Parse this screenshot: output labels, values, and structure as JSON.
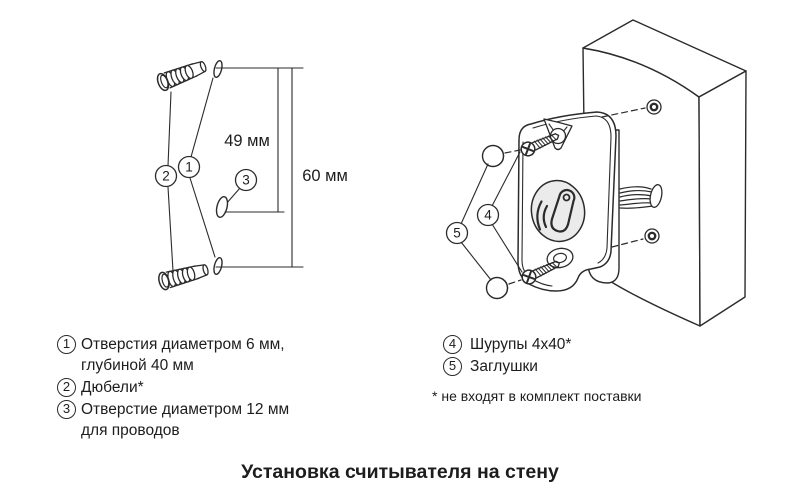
{
  "title": "Установка считывателя на стену",
  "diagram_left": {
    "dim_inner": "49 мм",
    "dim_outer": "60 мм",
    "callouts": {
      "c1": "1",
      "c2": "2",
      "c3": "3"
    }
  },
  "diagram_right": {
    "callouts": {
      "c4": "4",
      "c5": "5"
    }
  },
  "legend_left": {
    "items": [
      {
        "num": "1",
        "lines": [
          "Отверстия диаметром 6 мм,",
          "глубиной 40 мм"
        ]
      },
      {
        "num": "2",
        "lines": [
          "Дюбели*"
        ]
      },
      {
        "num": "3",
        "lines": [
          "Отверстие диаметром 12 мм",
          "для проводов"
        ]
      }
    ]
  },
  "legend_right": {
    "items": [
      {
        "num": "4",
        "lines": [
          "Шурупы 4x40*"
        ]
      },
      {
        "num": "5",
        "lines": [
          "Заглушки"
        ]
      }
    ],
    "footnote": "* не входят в комплект поставки"
  },
  "colors": {
    "line": "#2b2b2b",
    "text": "#1d1d1d",
    "oval_fill": "#ebebeb"
  }
}
